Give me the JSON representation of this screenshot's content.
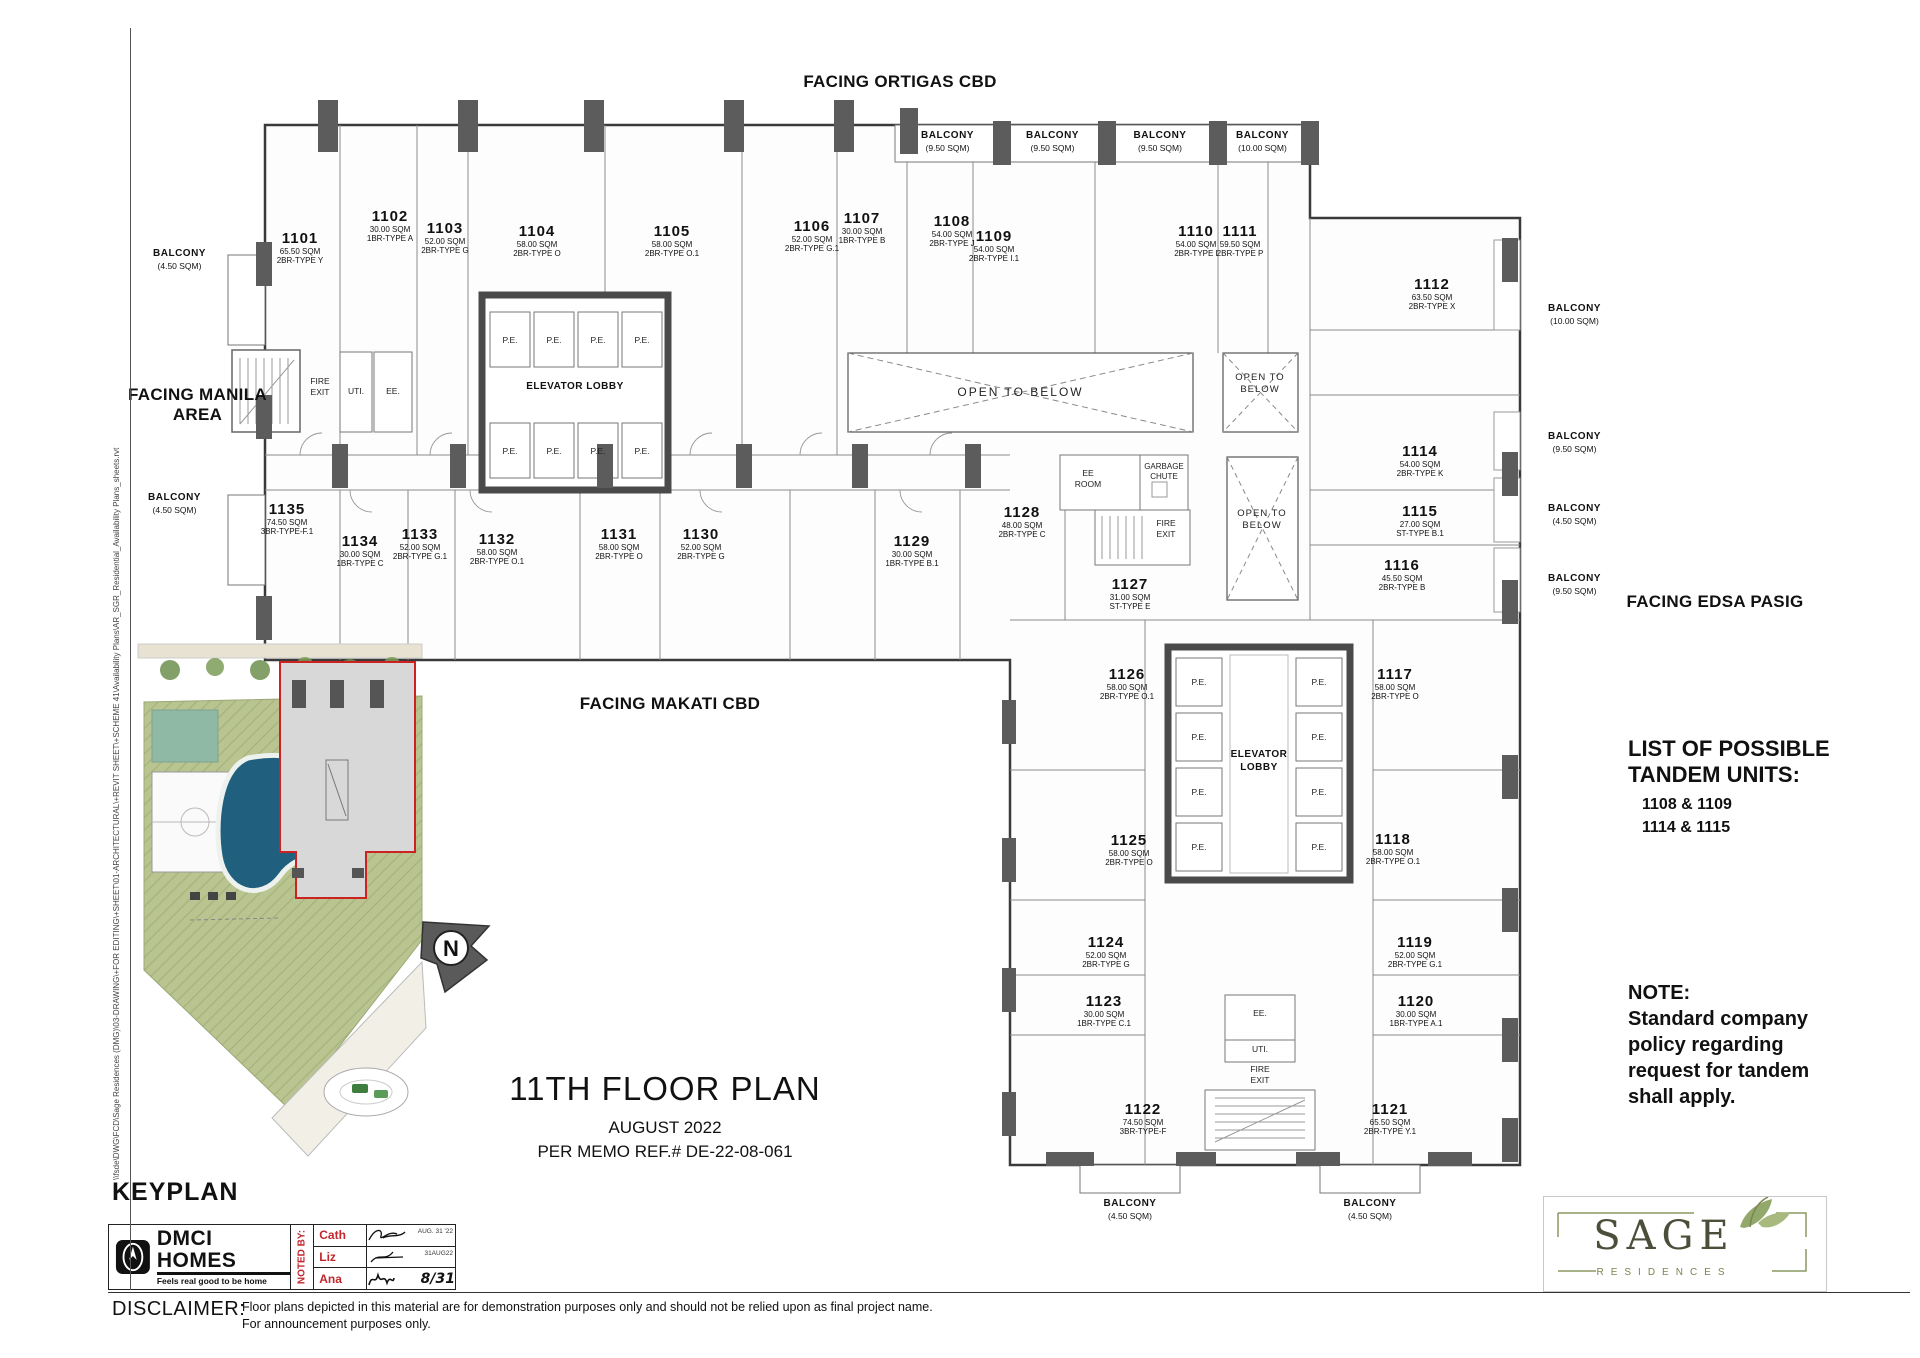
{
  "facing": {
    "north": "FACING ORTIGAS CBD",
    "west1": "FACING MANILA",
    "west2": "AREA",
    "south": "FACING MAKATI CBD",
    "east": "FACING EDSA PASIG"
  },
  "units": [
    {
      "number": "1101",
      "area": "65.50 SQM",
      "type": "2BR-TYPE Y"
    },
    {
      "number": "1102",
      "area": "30.00 SQM",
      "type": "1BR-TYPE A"
    },
    {
      "number": "1103",
      "area": "52.00 SQM",
      "type": "2BR-TYPE G"
    },
    {
      "number": "1104",
      "area": "58.00 SQM",
      "type": "2BR-TYPE O"
    },
    {
      "number": "1105",
      "area": "58.00 SQM",
      "type": "2BR-TYPE O.1"
    },
    {
      "number": "1106",
      "area": "52.00 SQM",
      "type": "2BR-TYPE G.1"
    },
    {
      "number": "1107",
      "area": "30.00 SQM",
      "type": "1BR-TYPE B"
    },
    {
      "number": "1108",
      "area": "54.00 SQM",
      "type": "2BR-TYPE J"
    },
    {
      "number": "1109",
      "area": "54.00 SQM",
      "type": "2BR-TYPE I.1"
    },
    {
      "number": "1110",
      "area": "54.00 SQM",
      "type": "2BR-TYPE I"
    },
    {
      "number": "1111",
      "area": "59.50 SQM",
      "type": "2BR-TYPE P"
    },
    {
      "number": "1112",
      "area": "63.50 SQM",
      "type": "2BR-TYPE X"
    },
    {
      "number": "1114",
      "area": "54.00 SQM",
      "type": "2BR-TYPE K"
    },
    {
      "number": "1115",
      "area": "27.00 SQM",
      "type": "ST-TYPE B.1"
    },
    {
      "number": "1116",
      "area": "45.50 SQM",
      "type": "2BR-TYPE B"
    },
    {
      "number": "1117",
      "area": "58.00 SQM",
      "type": "2BR-TYPE O"
    },
    {
      "number": "1118",
      "area": "58.00 SQM",
      "type": "2BR-TYPE O.1"
    },
    {
      "number": "1119",
      "area": "52.00 SQM",
      "type": "2BR-TYPE G.1"
    },
    {
      "number": "1120",
      "area": "30.00 SQM",
      "type": "1BR-TYPE A.1"
    },
    {
      "number": "1121",
      "area": "65.50 SQM",
      "type": "2BR-TYPE Y.1"
    },
    {
      "number": "1122",
      "area": "74.50 SQM",
      "type": "3BR-TYPE-F"
    },
    {
      "number": "1123",
      "area": "30.00 SQM",
      "type": "1BR-TYPE C.1"
    },
    {
      "number": "1124",
      "area": "52.00 SQM",
      "type": "2BR-TYPE G"
    },
    {
      "number": "1125",
      "area": "58.00 SQM",
      "type": "2BR-TYPE O"
    },
    {
      "number": "1126",
      "area": "58.00 SQM",
      "type": "2BR-TYPE O.1"
    },
    {
      "number": "1127",
      "area": "31.00 SQM",
      "type": "ST-TYPE E"
    },
    {
      "number": "1128",
      "area": "48.00 SQM",
      "type": "2BR-TYPE C"
    },
    {
      "number": "1129",
      "area": "30.00 SQM",
      "type": "1BR-TYPE B.1"
    },
    {
      "number": "1130",
      "area": "52.00 SQM",
      "type": "2BR-TYPE G"
    },
    {
      "number": "1131",
      "area": "58.00 SQM",
      "type": "2BR-TYPE O"
    },
    {
      "number": "1132",
      "area": "58.00 SQM",
      "type": "2BR-TYPE O.1"
    },
    {
      "number": "1133",
      "area": "52.00 SQM",
      "type": "2BR-TYPE G.1"
    },
    {
      "number": "1134",
      "area": "30.00 SQM",
      "type": "1BR-TYPE C"
    },
    {
      "number": "1135",
      "area": "74.50 SQM",
      "type": "3BR-TYPE-F.1"
    }
  ],
  "balconies": [
    {
      "name": "BALCONY",
      "size": "(9.50 SQM)"
    },
    {
      "name": "BALCONY",
      "size": "(9.50 SQM)"
    },
    {
      "name": "BALCONY",
      "size": "(9.50 SQM)"
    },
    {
      "name": "BALCONY",
      "size": "(10.00 SQM)"
    },
    {
      "name": "BALCONY",
      "size": "(10.00 SQM)"
    },
    {
      "name": "BALCONY",
      "size": "(9.50 SQM)"
    },
    {
      "name": "BALCONY",
      "size": "(4.50 SQM)"
    },
    {
      "name": "BALCONY",
      "size": "(9.50 SQM)"
    },
    {
      "name": "BALCONY",
      "size": "(4.50 SQM)"
    },
    {
      "name": "BALCONY",
      "size": "(4.50 SQM)"
    },
    {
      "name": "BALCONY",
      "size": "(4.50 SQM)"
    },
    {
      "name": "BALCONY",
      "size": "(4.50 SQM)"
    }
  ],
  "core": {
    "elevator_lobby": "ELEVATOR LOBBY",
    "pe": "P.E.",
    "fire_exit": "FIRE EXIT",
    "uti": "UTI.",
    "ee": "EE.",
    "ee_room": "EE ROOM",
    "garbage_chute": "GARBAGE CHUTE",
    "open_to_below": "OPEN TO BELOW"
  },
  "tandem": {
    "title1": "LIST OF POSSIBLE",
    "title2": "TANDEM UNITS:",
    "item1": "1108 & 1109",
    "item2": "1114 & 1115"
  },
  "note": {
    "heading": "NOTE:",
    "line1": "Standard company",
    "line2": "policy regarding",
    "line3": "request for tandem",
    "line4": "shall apply."
  },
  "titleblock": {
    "title": "11TH FLOOR PLAN",
    "date": "AUGUST 2022",
    "memo": "PER MEMO REF.# DE-22-08-061",
    "keyplan": "KEYPLAN",
    "north_letter": "N"
  },
  "branding": {
    "dmci_name": "DMCI HOMES",
    "dmci_tagline": "Feels real good to be home",
    "sage_name": "SAGE",
    "sage_sub": "RESIDENCES"
  },
  "noted_by": {
    "label": "NOTED BY:",
    "name1": "Cath",
    "name2": "Liz",
    "name3": "Ana",
    "date1": "AUG. 31 '22",
    "date2": "31AUG22",
    "date3": "8/31"
  },
  "disclaimer": {
    "label": "DISCLAIMER:",
    "line1": "Floor plans depicted in this material are for demonstration purposes only and should not be relied upon as final project name.",
    "line2": "For announcement purposes only."
  },
  "filepath": "\\\\fsde\\DWG\\FCD\\Sage Residences (DMG)\\03-DRAWING\\+FOR EDITING\\+SHEET\\01-ARCHITECTURAL\\+REVIT SHEET\\+SCHEME 41\\Availability Plans\\AR_SGR_Residential_Availability Plans_sheets.rvt",
  "colors": {
    "accent_red": "#c1272d",
    "sage_olive": "#7d8450",
    "wall_gray": "#5c5c5c",
    "pool_blue": "#20607e",
    "site_green": "#b9c490"
  }
}
